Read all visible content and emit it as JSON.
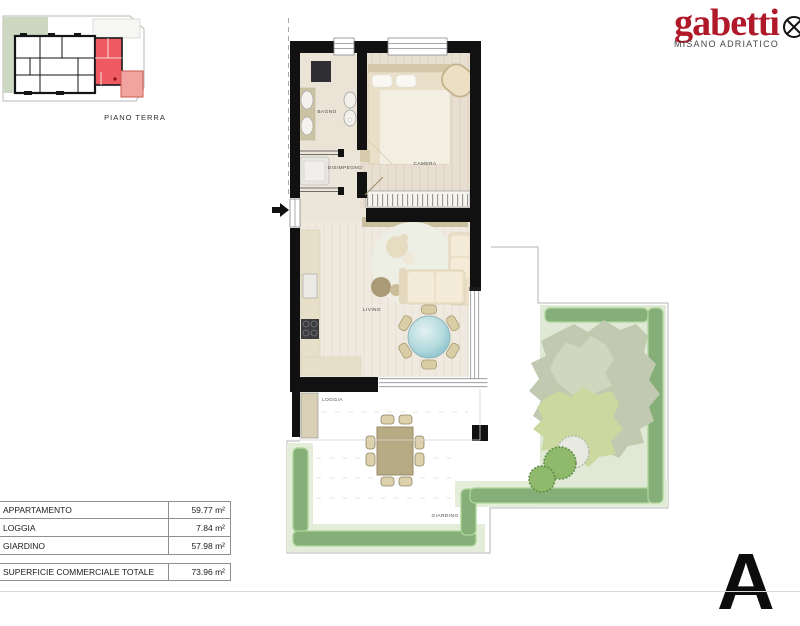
{
  "logo": {
    "brand": "gabetti",
    "location": "MISANO ADRIATICO",
    "mark_icon": "circle-x"
  },
  "key_plan": {
    "caption": "PIANO TERRA"
  },
  "floor_plan": {
    "rooms": {
      "bagno": "BAGNO",
      "camera": "CAMERA",
      "disimpegno": "DISIMPEGNO",
      "living": "LIVING",
      "loggia": "LOGGIA",
      "giardino": "GIARDINO"
    }
  },
  "areas_table": {
    "rows": [
      {
        "label": "APPARTAMENTO",
        "value": "59.77 m²"
      },
      {
        "label": "LOGGIA",
        "value": "7.84 m²"
      },
      {
        "label": "GIARDINO",
        "value": "57.98 m²"
      }
    ],
    "total": {
      "label": "SUPERFICIE COMMERCIALE TOTALE",
      "value": "73.96 m²"
    }
  },
  "unit_label": "A 3",
  "colors": {
    "brand_red": "#b0192a",
    "unit_highlight": "#ee5a62",
    "unit_highlight_light": "#f1a49f",
    "hedge_green": "#85ae78",
    "lawn_green": "#e0e9d5",
    "glass_teal": "#8cc3cc",
    "wall_black": "#111111"
  }
}
